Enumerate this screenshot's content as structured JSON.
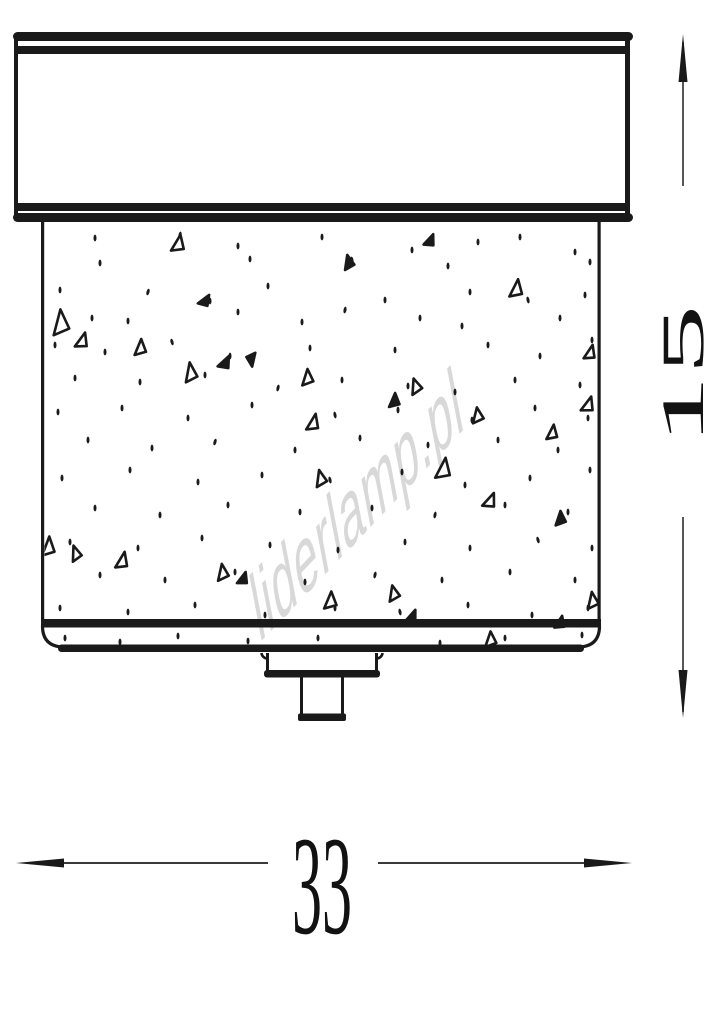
{
  "figure": {
    "watermark_text": "liderlamp.pl",
    "width_dimension_label": "33",
    "height_dimension_label": "15",
    "colors": {
      "ink": "#1a1a1a",
      "dimension_line": "#3a3a3a",
      "watermark": "#d8d8d8",
      "background": "#ffffff"
    },
    "speckles": {
      "dots": [
        [
          95,
          238
        ],
        [
          180,
          235,
          12
        ],
        [
          238,
          246
        ],
        [
          322,
          237
        ],
        [
          352,
          260,
          -10
        ],
        [
          412,
          250
        ],
        [
          478,
          242
        ],
        [
          520,
          237
        ],
        [
          575,
          252
        ],
        [
          100,
          263
        ],
        [
          250,
          259
        ],
        [
          448,
          266
        ],
        [
          590,
          262
        ],
        [
          60,
          290
        ],
        [
          148,
          292,
          15
        ],
        [
          210,
          301
        ],
        [
          268,
          286
        ],
        [
          385,
          300
        ],
        [
          470,
          292
        ],
        [
          528,
          300,
          -12
        ],
        [
          585,
          295
        ],
        [
          92,
          318
        ],
        [
          128,
          321
        ],
        [
          238,
          312
        ],
        [
          302,
          322
        ],
        [
          345,
          310,
          10
        ],
        [
          420,
          318
        ],
        [
          462,
          326
        ],
        [
          560,
          318
        ],
        [
          55,
          345
        ],
        [
          105,
          352
        ],
        [
          172,
          342,
          -15
        ],
        [
          230,
          356
        ],
        [
          310,
          348
        ],
        [
          395,
          350
        ],
        [
          488,
          345
        ],
        [
          540,
          356
        ],
        [
          592,
          340
        ],
        [
          75,
          378
        ],
        [
          140,
          382
        ],
        [
          205,
          375
        ],
        [
          278,
          388,
          12
        ],
        [
          342,
          380
        ],
        [
          408,
          386
        ],
        [
          455,
          392
        ],
        [
          515,
          380
        ],
        [
          580,
          385
        ],
        [
          58,
          412
        ],
        [
          122,
          408
        ],
        [
          188,
          418
        ],
        [
          252,
          405
        ],
        [
          335,
          415,
          -10
        ],
        [
          398,
          410
        ],
        [
          472,
          420
        ],
        [
          535,
          408
        ],
        [
          588,
          418
        ],
        [
          88,
          440
        ],
        [
          152,
          448
        ],
        [
          215,
          442,
          15
        ],
        [
          295,
          450
        ],
        [
          360,
          438
        ],
        [
          428,
          445
        ],
        [
          498,
          440
        ],
        [
          558,
          450
        ],
        [
          62,
          478
        ],
        [
          130,
          470
        ],
        [
          198,
          482
        ],
        [
          262,
          475
        ],
        [
          330,
          480,
          -12
        ],
        [
          402,
          472
        ],
        [
          465,
          485
        ],
        [
          530,
          478
        ],
        [
          590,
          470
        ],
        [
          95,
          508
        ],
        [
          160,
          515
        ],
        [
          228,
          505
        ],
        [
          300,
          512
        ],
        [
          372,
          508
        ],
        [
          435,
          515,
          10
        ],
        [
          505,
          505
        ],
        [
          568,
          512
        ],
        [
          70,
          542
        ],
        [
          138,
          548
        ],
        [
          202,
          538
        ],
        [
          270,
          545
        ],
        [
          338,
          550
        ],
        [
          405,
          542
        ],
        [
          470,
          548
        ],
        [
          538,
          540,
          -15
        ],
        [
          592,
          548
        ],
        [
          100,
          575
        ],
        [
          165,
          580
        ],
        [
          235,
          572
        ],
        [
          305,
          582
        ],
        [
          375,
          575,
          12
        ],
        [
          442,
          580
        ],
        [
          510,
          572
        ],
        [
          575,
          580
        ],
        [
          60,
          608
        ],
        [
          128,
          612
        ],
        [
          195,
          605
        ],
        [
          265,
          615
        ],
        [
          335,
          608
        ],
        [
          400,
          612,
          -10
        ],
        [
          468,
          605
        ],
        [
          532,
          615
        ],
        [
          588,
          608
        ],
        [
          65,
          638
        ],
        [
          120,
          642
        ],
        [
          178,
          636
        ],
        [
          248,
          641
        ],
        [
          318,
          638
        ],
        [
          440,
          643
        ],
        [
          505,
          638
        ],
        [
          582,
          635
        ]
      ],
      "triangles": [
        [
          178,
          243,
          13,
          17,
          8
        ],
        [
          348,
          262,
          11,
          14,
          -15
        ],
        [
          430,
          240,
          10,
          13,
          20
        ],
        [
          516,
          288,
          13,
          18,
          5
        ],
        [
          60,
          322,
          17,
          25,
          -6
        ],
        [
          82,
          340,
          12,
          16,
          14
        ],
        [
          140,
          347,
          12,
          16,
          0
        ],
        [
          190,
          372,
          13,
          19,
          -10
        ],
        [
          225,
          362,
          11,
          14,
          24
        ],
        [
          252,
          360,
          10,
          13,
          170
        ],
        [
          307,
          377,
          12,
          16,
          -5
        ],
        [
          313,
          422,
          12,
          17,
          10
        ],
        [
          415,
          386,
          12,
          15,
          -20
        ],
        [
          394,
          400,
          11,
          14,
          0
        ],
        [
          588,
          404,
          12,
          16,
          15
        ],
        [
          477,
          415,
          12,
          15,
          -10
        ],
        [
          552,
          432,
          11,
          15,
          5
        ],
        [
          320,
          478,
          12,
          16,
          -15
        ],
        [
          443,
          468,
          15,
          21,
          6
        ],
        [
          490,
          500,
          12,
          16,
          20
        ],
        [
          560,
          518,
          11,
          14,
          -5
        ],
        [
          48,
          546,
          13,
          19,
          0
        ],
        [
          75,
          553,
          11,
          15,
          -20
        ],
        [
          122,
          560,
          12,
          17,
          10
        ],
        [
          222,
          572,
          12,
          16,
          -10
        ],
        [
          243,
          578,
          10,
          13,
          15
        ],
        [
          330,
          600,
          13,
          17,
          0
        ],
        [
          393,
          593,
          12,
          15,
          -15
        ],
        [
          412,
          616,
          10,
          14,
          20
        ],
        [
          490,
          639,
          12,
          15,
          -5
        ],
        [
          560,
          622,
          10,
          13,
          10
        ],
        [
          592,
          600,
          12,
          16,
          -10
        ],
        [
          590,
          352,
          11,
          15,
          12
        ],
        [
          205,
          300,
          10,
          13,
          30
        ]
      ]
    }
  }
}
